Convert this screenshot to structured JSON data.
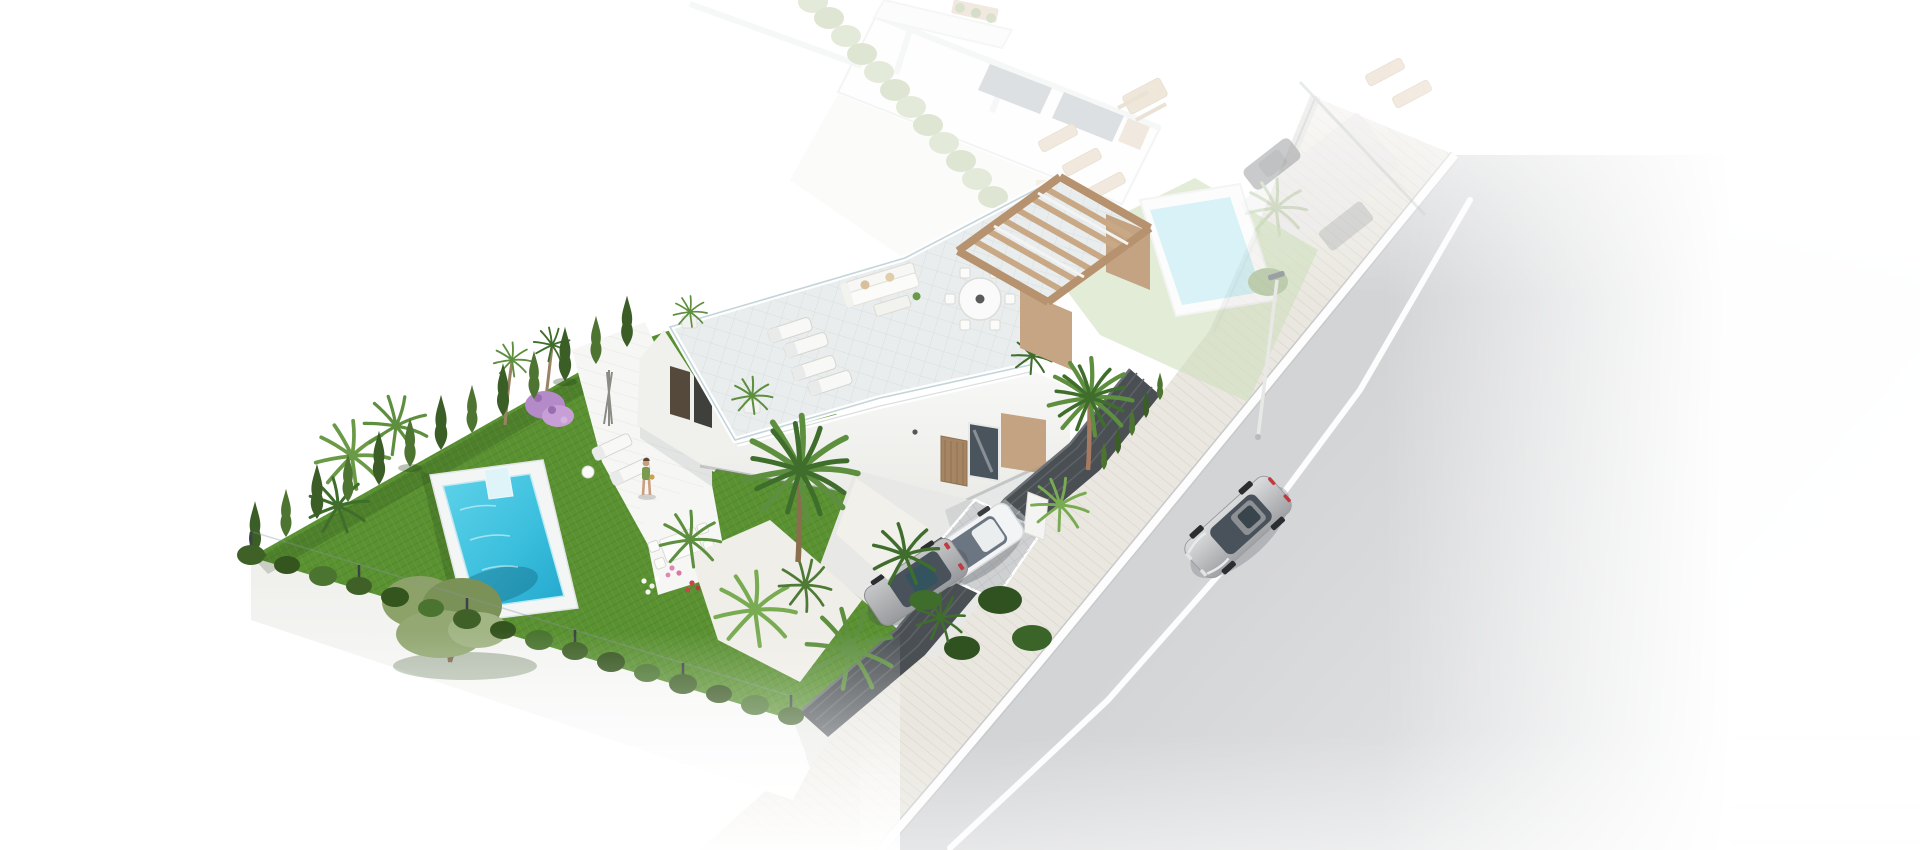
{
  "meta": {
    "title": "Aerial 3D architectural render of a modern villa plot with private pool beside a street",
    "view_label": "Isometric aerial view",
    "scene_label": "New-build villa visualization"
  },
  "colors": {
    "background": "#ffffff",
    "lawn": "#5a9131",
    "lawnEdge": "#4c7e27",
    "cypress": "#3b5d26",
    "cypressLight": "#4d7531",
    "hedgeBush": "#3f6127",
    "palm": "#5d8f3f",
    "palmDark": "#3f6d2c",
    "palmLight": "#79ab52",
    "olive": "#8da268",
    "oliveDark": "#7a9157",
    "poolDeck": "#f4f6f6",
    "poolLedge": "#dff4f8",
    "deckFloor": "#e9edee",
    "villaWhite": "#f6f6f4",
    "sideWall": "#f0f0ed",
    "stepRoof": "#f3f4f3",
    "accentTan": "#c4a382",
    "pergolaTan": "#c9a985",
    "pergolaBeam": "#b6926f",
    "pergolaWall": "#c6a585",
    "doorWood": "#a58563",
    "glassDark": "#4a545c",
    "panelWood": "#55493c",
    "panelDark": "#3f3f3b",
    "fenceDark": "#4a4f53",
    "fenceGate": "#8d9397",
    "road": "#d5d6d8",
    "sidewalk": "#eae7e0",
    "curb": "#fdfdfd",
    "lane": "#ffffff",
    "driveway": "#cfd0d2",
    "driveFloor": "#e8e8e6",
    "carSilverRoof": "#49525a",
    "carWhite": "#f3f4f5",
    "carWhiteGlass": "#6b7682",
    "carGraySunroof": "#33545e",
    "carGhost": "#6f7478",
    "vanGhost": "#a7acb0",
    "gravel": "#efeee8",
    "flowerPurple": "#b48bc8",
    "flowerPurpleLight": "#c79fd6",
    "flowerPink": "#e087b1",
    "flowerRed": "#c64747",
    "flowerWhite": "#f7f7f3",
    "skin": "#c99f7e",
    "dressGreen": "#7a9a4f",
    "trunk": "#8a6f4e",
    "trunkRed": "#a87a62",
    "ghostHedge": "#b7c69a",
    "ghostLawn": "#cfe0bd",
    "ghostPool": "#bfe9f2",
    "ghostGlass": "#a3adb3",
    "ghostTan": "#d9c3a9",
    "lampPole": "#e8e8e6"
  },
  "scene": {
    "road": {
      "label": "Asphalt street with white lane marking",
      "surface": "asphalt"
    },
    "sidewalk": {
      "label": "Paved sidewalk along plot boundary"
    },
    "street_lamp": {
      "label": "Street lamp on sidewalk"
    },
    "street_car": {
      "label": "Silver car driving on the street",
      "color_name": "silver"
    },
    "main_property": {
      "label": "Main villa plot",
      "villa": {
        "label": "Modern white villa with roof terrace"
      },
      "roof_terrace": {
        "label": "Roof terrace with sun loungers, lounge sofa and round dining table"
      },
      "pergola": {
        "label": "Timber pergola on roof terrace"
      },
      "pool": {
        "label": "Turquoise private swimming pool with white deck"
      },
      "garden": {
        "label": "Lawn garden with olive tree, palms and cypress hedge"
      },
      "patio": {
        "label": "Ground floor terrace with loungers and dining set"
      },
      "woman": {
        "label": "Woman standing on the terrace"
      },
      "driveway": {
        "label": "Driveway with two parked cars behind slatted fence"
      },
      "car_gray": {
        "label": "Silver-gray parked car"
      },
      "car_white": {
        "label": "White parked car"
      },
      "gate": {
        "label": "Dark slatted driveway gate"
      }
    },
    "neighbor_property": {
      "label": "Ghosted neighbouring villa plot",
      "villa": {
        "label": "Faded neighbouring villa"
      },
      "pool": {
        "label": "Faded neighbouring pool"
      },
      "car": {
        "label": "Faded parked car"
      },
      "hedge": {
        "label": "Faded boundary hedge"
      }
    }
  }
}
